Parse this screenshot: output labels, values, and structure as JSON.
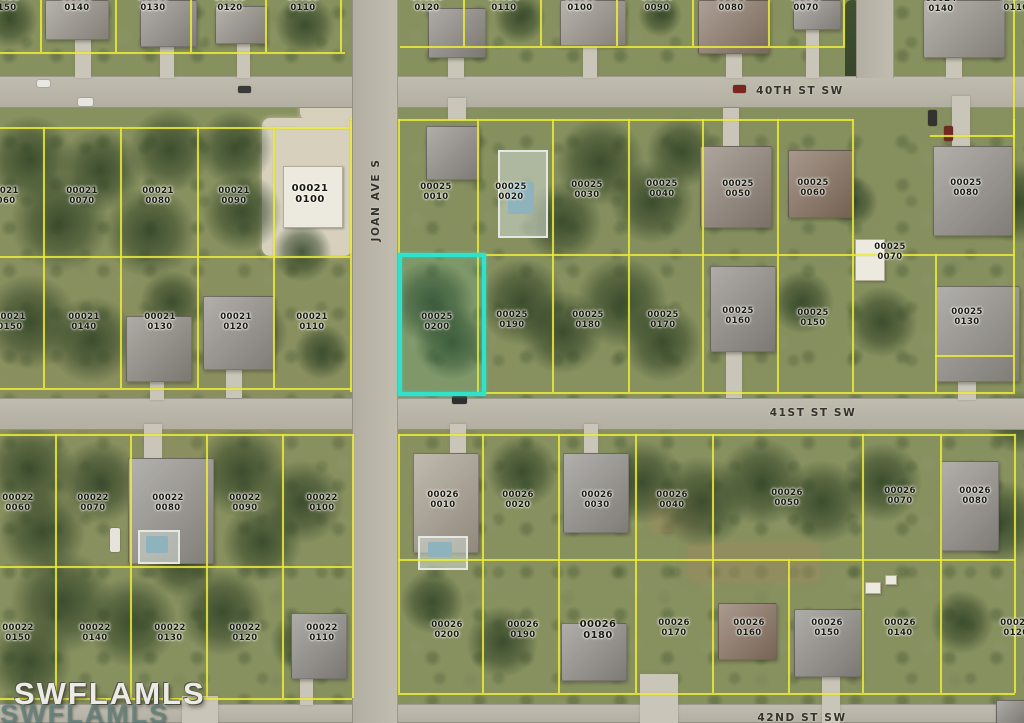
{
  "map": {
    "watermark": {
      "primary": "SWFLAMLS",
      "secondary": "SWFLAMLS"
    },
    "colors": {
      "highlight": "#2FE2CC",
      "parcel_lines": "#E8E83C"
    },
    "subject_parcel": {
      "block": "00025",
      "lot": "0200"
    },
    "streets": [
      {
        "name": "40TH ST SW",
        "x": 800,
        "y": 91,
        "orientation": "h"
      },
      {
        "name": "41ST ST SW",
        "x": 813,
        "y": 413,
        "orientation": "h"
      },
      {
        "name": "42ND ST SW",
        "x": 802,
        "y": 718,
        "orientation": "h"
      },
      {
        "name": "JOAN AVE S",
        "x": 376,
        "y": 200,
        "orientation": "v"
      }
    ],
    "parcels": [
      {
        "block": "00020",
        "lot": "0150",
        "x": 4,
        "y": 3
      },
      {
        "block": "00020",
        "lot": "0140",
        "x": 77,
        "y": 3
      },
      {
        "block": "00020",
        "lot": "0130",
        "x": 153,
        "y": 3
      },
      {
        "block": "00020",
        "lot": "0120",
        "x": 230,
        "y": 3
      },
      {
        "block": "00020",
        "lot": "0110",
        "x": 303,
        "y": 3
      },
      {
        "block": "00024",
        "lot": "0120",
        "x": 427,
        "y": 3
      },
      {
        "block": "00024",
        "lot": "0110",
        "x": 504,
        "y": 3
      },
      {
        "block": "00024",
        "lot": "0100",
        "x": 580,
        "y": 3
      },
      {
        "block": "00024",
        "lot": "0090",
        "x": 657,
        "y": 3
      },
      {
        "block": "00024",
        "lot": "0080",
        "x": 731,
        "y": 3
      },
      {
        "block": "00024",
        "lot": "0070",
        "x": 806,
        "y": 3
      },
      {
        "block": "00024",
        "lot": "0140",
        "x": 941,
        "y": 4
      },
      {
        "block": "00024",
        "lot": "0110",
        "x": 1016,
        "y": 3
      },
      {
        "block": "00021",
        "lot": "0060",
        "x": 3,
        "y": 196
      },
      {
        "block": "00021",
        "lot": "0070",
        "x": 82,
        "y": 196
      },
      {
        "block": "00021",
        "lot": "0080",
        "x": 158,
        "y": 196
      },
      {
        "block": "00021",
        "lot": "0090",
        "x": 234,
        "y": 196
      },
      {
        "block": "00021",
        "lot": "0100",
        "x": 310,
        "y": 194,
        "emphasis": true
      },
      {
        "block": "00021",
        "lot": "0150",
        "x": 10,
        "y": 322
      },
      {
        "block": "00021",
        "lot": "0140",
        "x": 84,
        "y": 322
      },
      {
        "block": "00021",
        "lot": "0130",
        "x": 160,
        "y": 322
      },
      {
        "block": "00021",
        "lot": "0120",
        "x": 236,
        "y": 322
      },
      {
        "block": "00021",
        "lot": "0110",
        "x": 312,
        "y": 322
      },
      {
        "block": "00025",
        "lot": "0010",
        "x": 436,
        "y": 192
      },
      {
        "block": "00025",
        "lot": "0020",
        "x": 511,
        "y": 192
      },
      {
        "block": "00025",
        "lot": "0030",
        "x": 587,
        "y": 190
      },
      {
        "block": "00025",
        "lot": "0040",
        "x": 662,
        "y": 189
      },
      {
        "block": "00025",
        "lot": "0050",
        "x": 738,
        "y": 189
      },
      {
        "block": "00025",
        "lot": "0060",
        "x": 813,
        "y": 188
      },
      {
        "block": "00025",
        "lot": "0080",
        "x": 966,
        "y": 188
      },
      {
        "block": "00025",
        "lot": "0070",
        "x": 890,
        "y": 252
      },
      {
        "block": "00025",
        "lot": "0200",
        "x": 437,
        "y": 322,
        "subject": true
      },
      {
        "block": "00025",
        "lot": "0190",
        "x": 512,
        "y": 320
      },
      {
        "block": "00025",
        "lot": "0180",
        "x": 588,
        "y": 320
      },
      {
        "block": "00025",
        "lot": "0170",
        "x": 663,
        "y": 320
      },
      {
        "block": "00025",
        "lot": "0160",
        "x": 738,
        "y": 316
      },
      {
        "block": "00025",
        "lot": "0150",
        "x": 813,
        "y": 318
      },
      {
        "block": "00025",
        "lot": "0130",
        "x": 967,
        "y": 317
      },
      {
        "block": "00022",
        "lot": "0060",
        "x": 18,
        "y": 503
      },
      {
        "block": "00022",
        "lot": "0070",
        "x": 93,
        "y": 503
      },
      {
        "block": "00022",
        "lot": "0080",
        "x": 168,
        "y": 503
      },
      {
        "block": "00022",
        "lot": "0090",
        "x": 245,
        "y": 503
      },
      {
        "block": "00022",
        "lot": "0100",
        "x": 322,
        "y": 503
      },
      {
        "block": "00022",
        "lot": "0150",
        "x": 18,
        "y": 633
      },
      {
        "block": "00022",
        "lot": "0140",
        "x": 95,
        "y": 633
      },
      {
        "block": "00022",
        "lot": "0130",
        "x": 170,
        "y": 633
      },
      {
        "block": "00022",
        "lot": "0120",
        "x": 245,
        "y": 633
      },
      {
        "block": "00022",
        "lot": "0110",
        "x": 322,
        "y": 633
      },
      {
        "block": "00026",
        "lot": "0010",
        "x": 443,
        "y": 500
      },
      {
        "block": "00026",
        "lot": "0020",
        "x": 518,
        "y": 500
      },
      {
        "block": "00026",
        "lot": "0030",
        "x": 597,
        "y": 500
      },
      {
        "block": "00026",
        "lot": "0040",
        "x": 672,
        "y": 500
      },
      {
        "block": "00026",
        "lot": "0050",
        "x": 787,
        "y": 498
      },
      {
        "block": "00026",
        "lot": "0070",
        "x": 900,
        "y": 496
      },
      {
        "block": "00026",
        "lot": "0080",
        "x": 975,
        "y": 496
      },
      {
        "block": "00026",
        "lot": "0200",
        "x": 447,
        "y": 630
      },
      {
        "block": "00026",
        "lot": "0190",
        "x": 523,
        "y": 630
      },
      {
        "block": "00026",
        "lot": "0180",
        "x": 598,
        "y": 630,
        "emphasis": true
      },
      {
        "block": "00026",
        "lot": "0170",
        "x": 674,
        "y": 628
      },
      {
        "block": "00026",
        "lot": "0160",
        "x": 749,
        "y": 628
      },
      {
        "block": "00026",
        "lot": "0150",
        "x": 827,
        "y": 628
      },
      {
        "block": "00026",
        "lot": "0140",
        "x": 900,
        "y": 628
      },
      {
        "block": "00026",
        "lot": "0120",
        "x": 1016,
        "y": 628
      }
    ]
  }
}
